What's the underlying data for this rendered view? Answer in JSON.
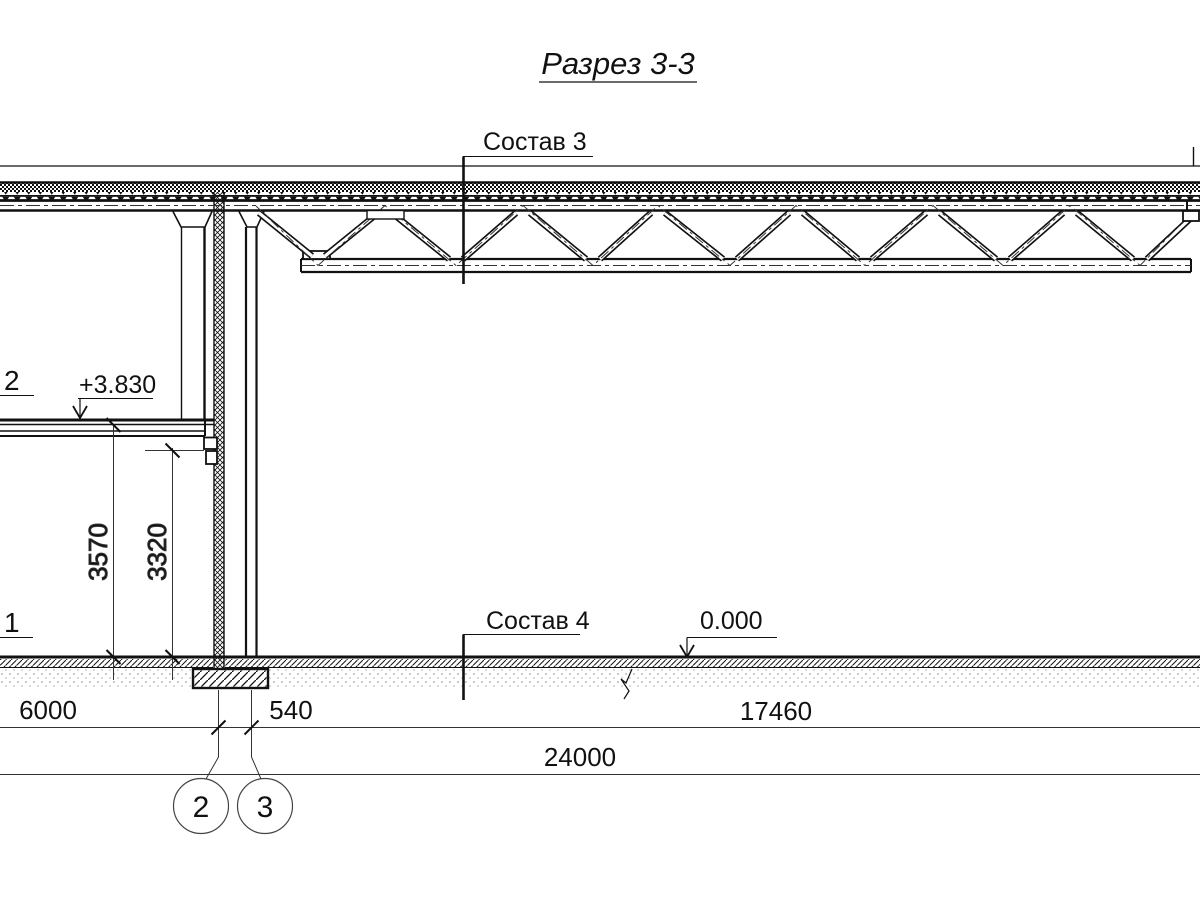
{
  "drawing": {
    "title": "Разрез 3-3",
    "section_labels": {
      "sostav3": "Состав 3",
      "sostav4": "Состав 4"
    },
    "levels": {
      "floor": "+3.830",
      "ground": "0.000"
    },
    "edge_labels": {
      "upper": "2",
      "lower": "1"
    },
    "dims": {
      "h_6000": "6000",
      "h_540": "540",
      "h_17460": "17460",
      "h_24000": "24000",
      "v_3570": "3570",
      "v_3320": "3320"
    },
    "grid_axes": {
      "axis_2": "2",
      "axis_3": "3"
    },
    "colors": {
      "ink": "#111111",
      "paper": "#ffffff"
    }
  }
}
